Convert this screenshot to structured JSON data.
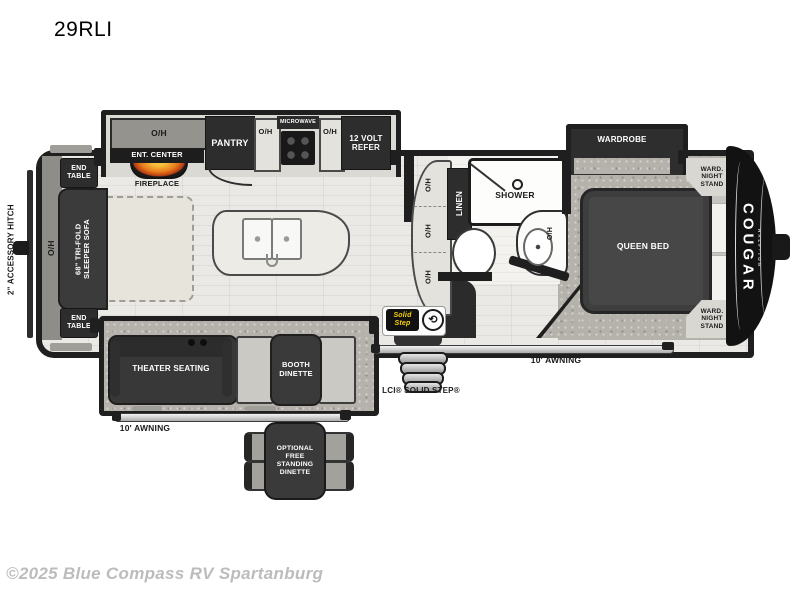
{
  "title": "29RLI",
  "copyright": "©2025 Blue Compass RV Spartanburg",
  "colors": {
    "flame_orange": "#e8791c",
    "step_logo_yellow": "#f7d40a",
    "wall_black": "#1f1f1f"
  },
  "exterior": {
    "hitch_label": "2\" ACCESSORY HITCH",
    "brand": "COUGAR",
    "brand_sub": "HALF-TON",
    "awning_left": "10' AWNING",
    "awning_right": "10' AWNING",
    "step_label": "LCI® SOLID STEP®",
    "step_logo": "Solid\nStep",
    "step_logo_icon": "⟲"
  },
  "rear": {
    "end_table_top": "END\nTABLE",
    "overhead": "O/H",
    "sofa": "68\" TRI-FOLD\nSLEEPER SOFA",
    "end_table_bottom": "END\nTABLE"
  },
  "kitchen": {
    "overhead_cabinet": "O/H",
    "ent_center": "ENT. CENTER",
    "fireplace": "FIREPLACE",
    "pantry": "PANTRY",
    "overhead_left": "O/H",
    "microwave": "MICROWAVE",
    "overhead_right": "O/H",
    "refer": "12 VOLT\nREFER",
    "counter_overhead_1": "O/H",
    "counter_overhead_2": "O/H",
    "counter_overhead_3": "O/H"
  },
  "bath": {
    "linen": "LINEN",
    "shower": "SHOWER",
    "sink_overhead": "O/H"
  },
  "bedroom": {
    "wardrobe": "WARDROBE",
    "queen_bed": "QUEEN BED",
    "nightstand_top": "WARD.\nNIGHT\nSTAND",
    "nightstand_bottom": "WARD.\nNIGHT\nSTAND"
  },
  "living": {
    "theater_seating": "THEATER SEATING",
    "booth_dinette": "BOOTH\nDINETTE",
    "optional_dinette": "OPTIONAL\nFREE\nSTANDING\nDINETTE"
  }
}
